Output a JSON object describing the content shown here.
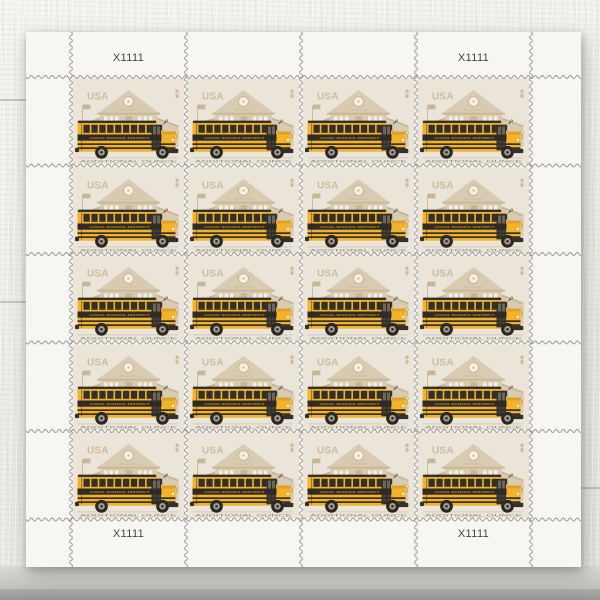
{
  "sheet": {
    "grid": {
      "rows": 5,
      "cols": 4,
      "stamp_count": 20
    },
    "plate_labels": {
      "top_left": "X1111",
      "top_right": "X1111",
      "bottom_left": "X1111",
      "bottom_right": "X1111"
    }
  },
  "stamp": {
    "country": "USA",
    "school_sign": "SCHOOL",
    "bus_side_text": "LOCAL SCHOOL DISTRICT",
    "caption": "ADDITIONAL OUNCE",
    "colors": {
      "stamp_bg": "#ebe5d9",
      "selvage_white": "#f7f6f3",
      "perforation_gray": "#8e8e8c",
      "schoolhouse_tan": "#d8cbb1",
      "schoolhouse_tan_dark": "#c7b794",
      "bus_yellow": "#f2b22c",
      "bus_yellow_dark": "#dd9c26",
      "bus_dark": "#33302a",
      "band_dark": "#2e2b26",
      "caption_color": "#8e8370",
      "usa_tan": "#cbbc9e",
      "wheel_hub": "#a39f97",
      "detail_white": "#f3efe4"
    }
  }
}
